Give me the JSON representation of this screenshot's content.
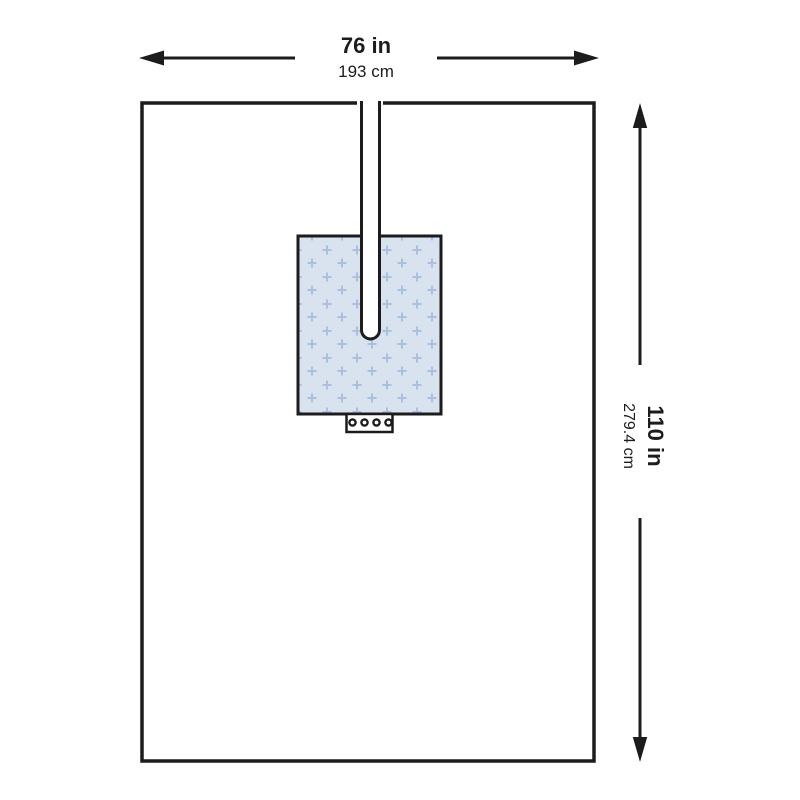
{
  "drape": {
    "width_dimension": {
      "inches": "76 in",
      "centimeters": "193 cm"
    },
    "height_dimension": {
      "inches": "110 in",
      "centimeters": "279.4 cm"
    }
  },
  "colors": {
    "fenestration_fill": "#d9e2ef",
    "fenestration_pattern": "#aac0de"
  }
}
